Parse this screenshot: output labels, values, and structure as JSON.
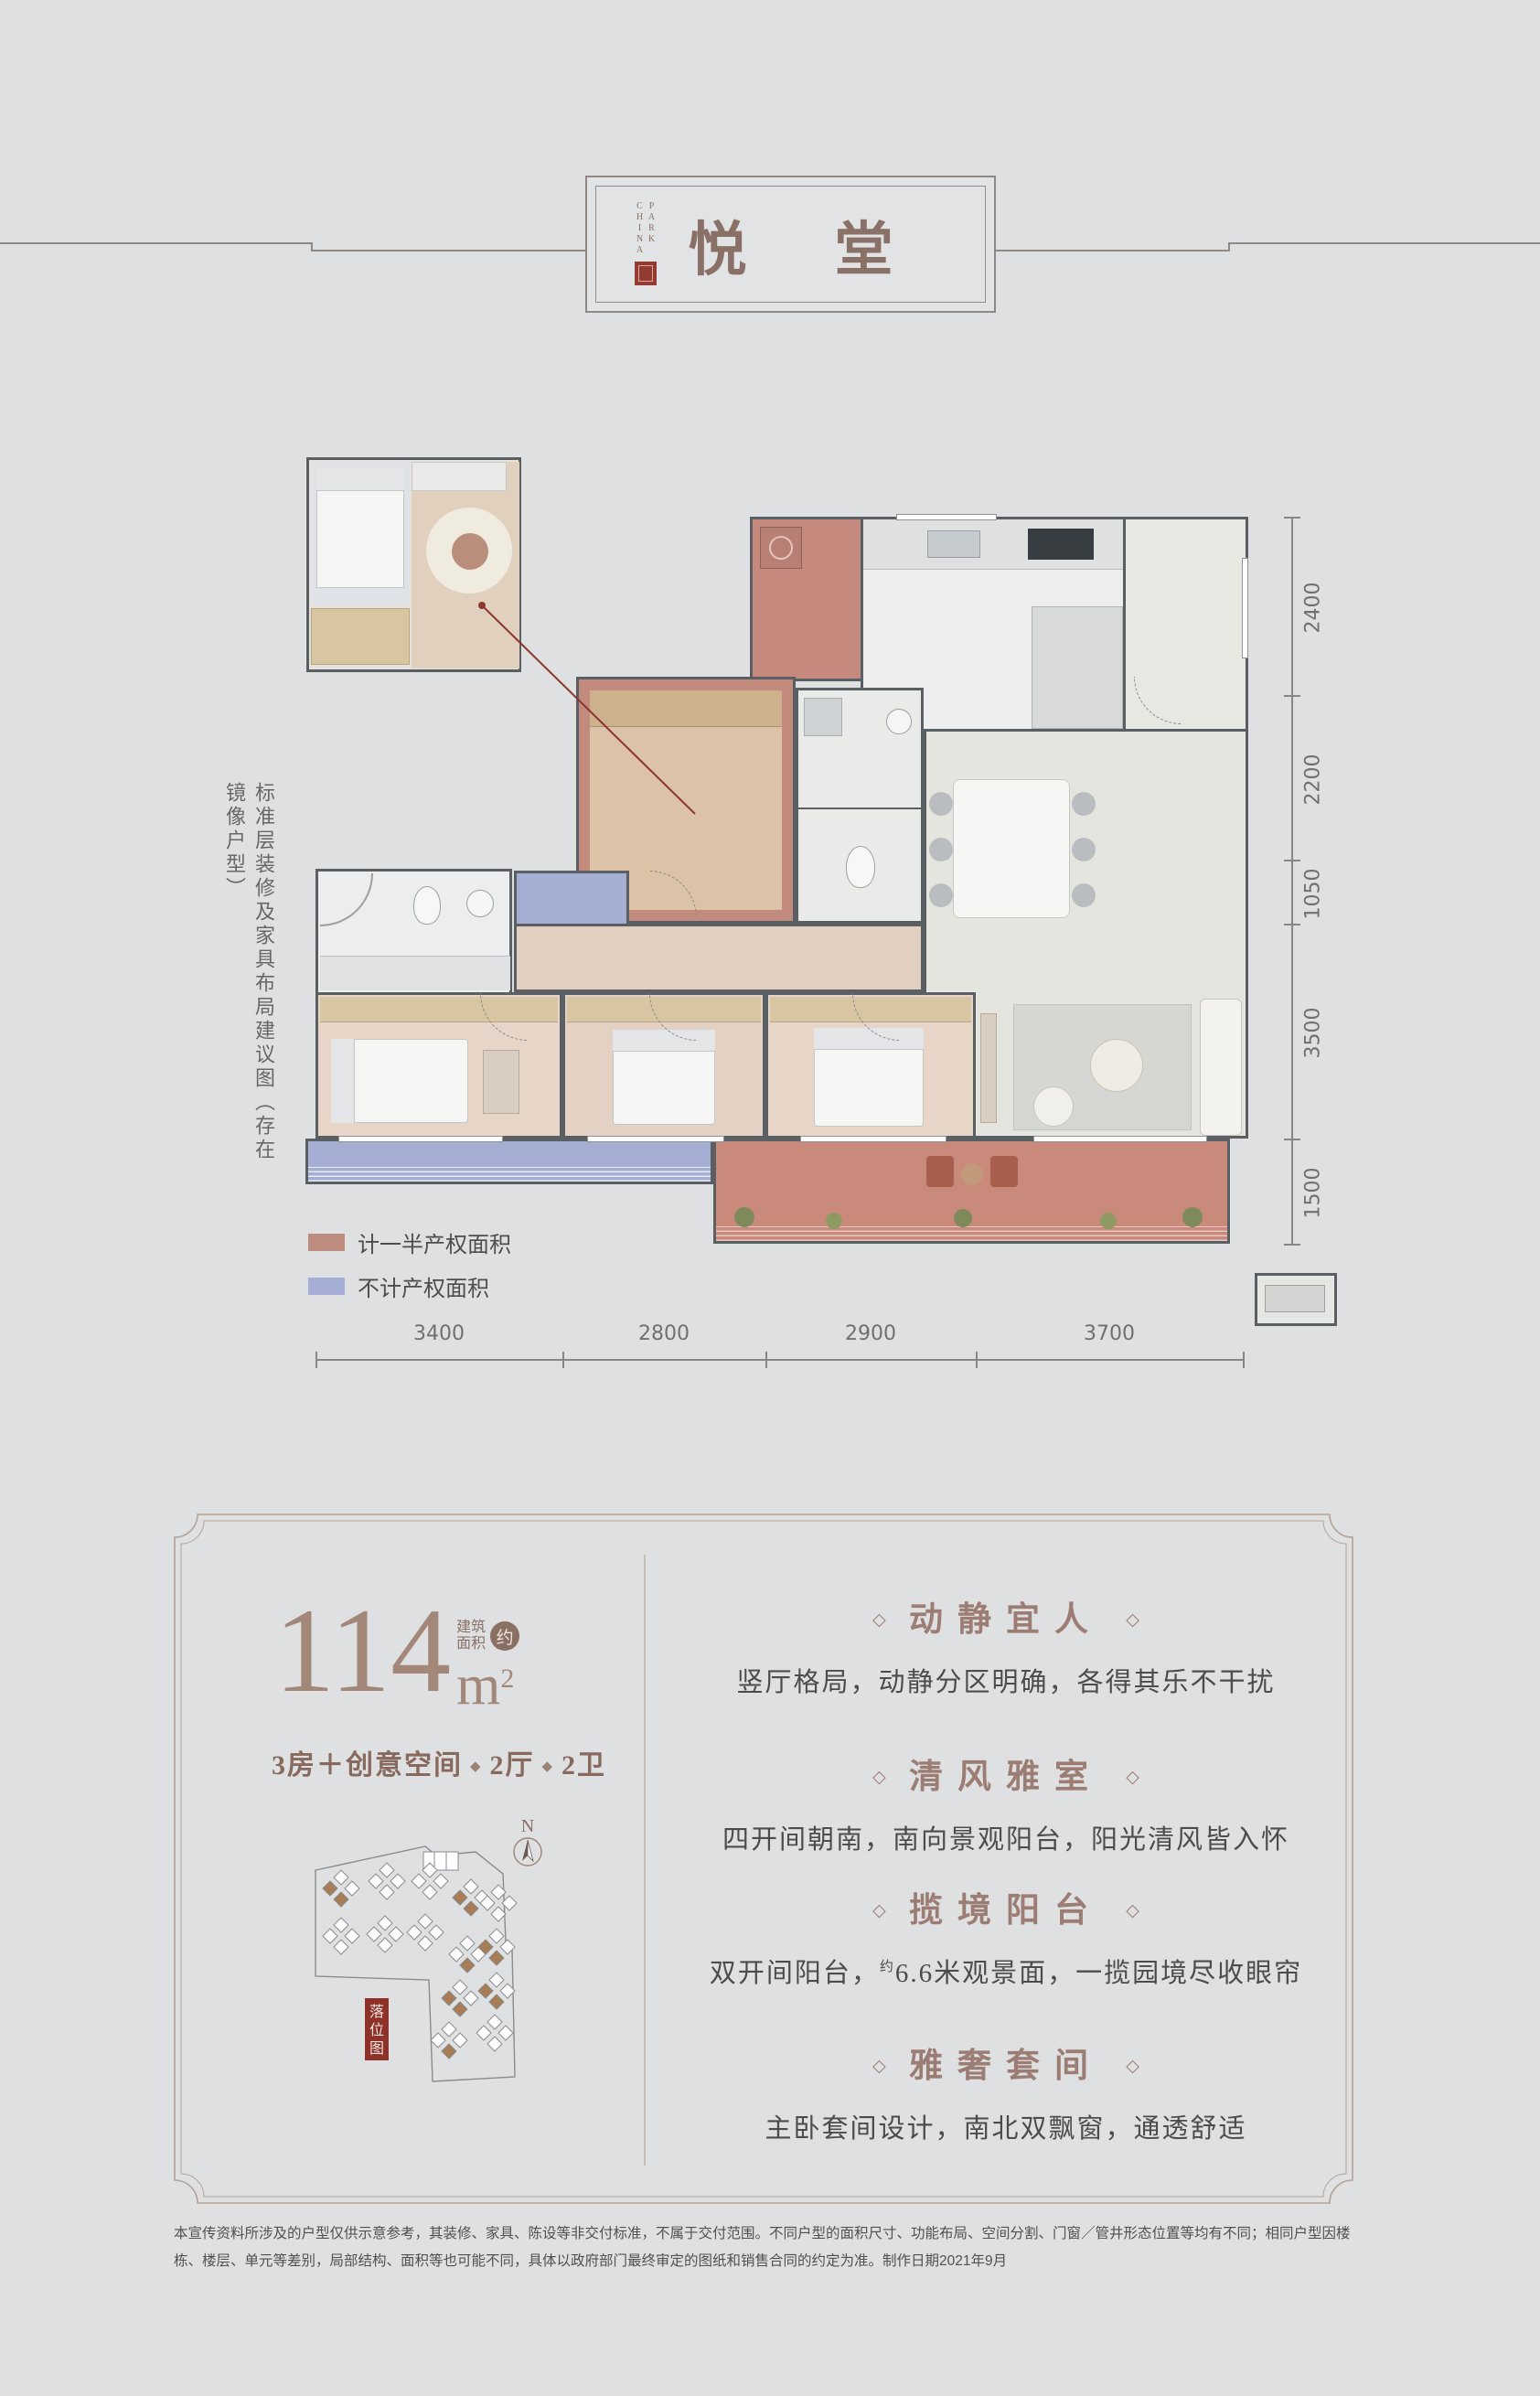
{
  "header": {
    "brand_line1": "CHINA",
    "brand_line2": "PARK",
    "title_char1": "悦",
    "title_char2": "堂"
  },
  "plan": {
    "caption": "标准层装修及家具布局建议图（存在镜像户型）",
    "legend": [
      {
        "color": "#bd8c7f",
        "label": "计一半产权面积"
      },
      {
        "color": "#a5afd6",
        "label": "不计产权面积"
      }
    ],
    "dims_bottom": [
      "3400",
      "2800",
      "2900",
      "3700"
    ],
    "dims_right": [
      "2400",
      "2200",
      "1050",
      "3500",
      "1500"
    ]
  },
  "summary": {
    "area_value": "114",
    "area_unit": "m",
    "area_exp": "2",
    "area_label_top": "建筑",
    "area_label_bottom": "面积",
    "area_approx": "约",
    "tagline_1": "3房＋创意空间",
    "tagline_2": "2厅",
    "tagline_3": "2卫",
    "tagline_sep": "◆"
  },
  "siteplan": {
    "north": "N",
    "seal_1": "落",
    "seal_2": "位",
    "seal_3": "图"
  },
  "features": {
    "deco": "◇",
    "items": [
      {
        "title": "动静宜人",
        "desc": "竖厅格局，动静分区明确，各得其乐不干扰"
      },
      {
        "title": "清风雅室",
        "desc": "四开间朝南，南向景观阳台，阳光清风皆入怀"
      },
      {
        "title": "揽境阳台",
        "desc_pre": "双开间阳台，",
        "desc_sup": "约",
        "desc_post": "6.6米观景面，一揽园境尽收眼帘"
      },
      {
        "title": "雅奢套间",
        "desc": "主卧套间设计，南北双飘窗，通透舒适"
      }
    ]
  },
  "disclaimer": "本宣传资料所涉及的户型仅供示意参考，其装修、家具、陈设等非交付标准，不属于交付范围。不同户型的面积尺寸、功能布局、空间分割、门窗／管井形态位置等均有不同；相同户型因楼栋、楼层、单元等差别，局部结构、面积等也可能不同，具体以政府部门最终审定的图纸和销售合同的约定为准。制作日期2021年9月"
}
